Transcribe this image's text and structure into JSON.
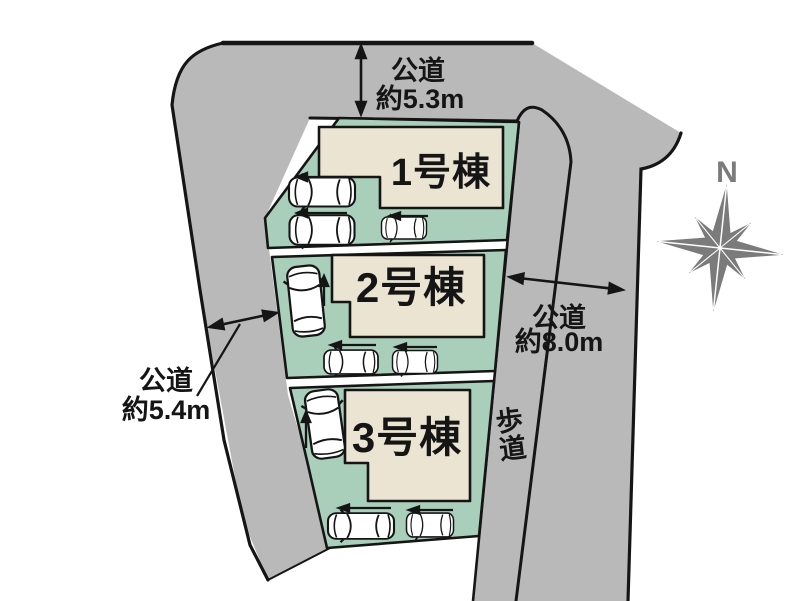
{
  "colors": {
    "road_gray": "#b9b9b9",
    "plot_green": "#a9ceba",
    "building_beige": "#ece4d3",
    "outline_black": "#151515",
    "compass_gray": "#7b7b7b",
    "background": "#ffffff"
  },
  "lots": [
    {
      "building_label": "1号棟"
    },
    {
      "building_label": "2号棟"
    },
    {
      "building_label": "3号棟"
    }
  ],
  "dimensions": {
    "top_road": {
      "name": "公道",
      "width": "約5.3m"
    },
    "right_road": {
      "name": "公道",
      "width": "約8.0m"
    },
    "left_road": {
      "name": "公道",
      "width": "約5.4m"
    }
  },
  "sidewalk": {
    "label": "歩道",
    "char1": "歩",
    "char2": "道"
  },
  "compass": {
    "north_label": "N"
  }
}
